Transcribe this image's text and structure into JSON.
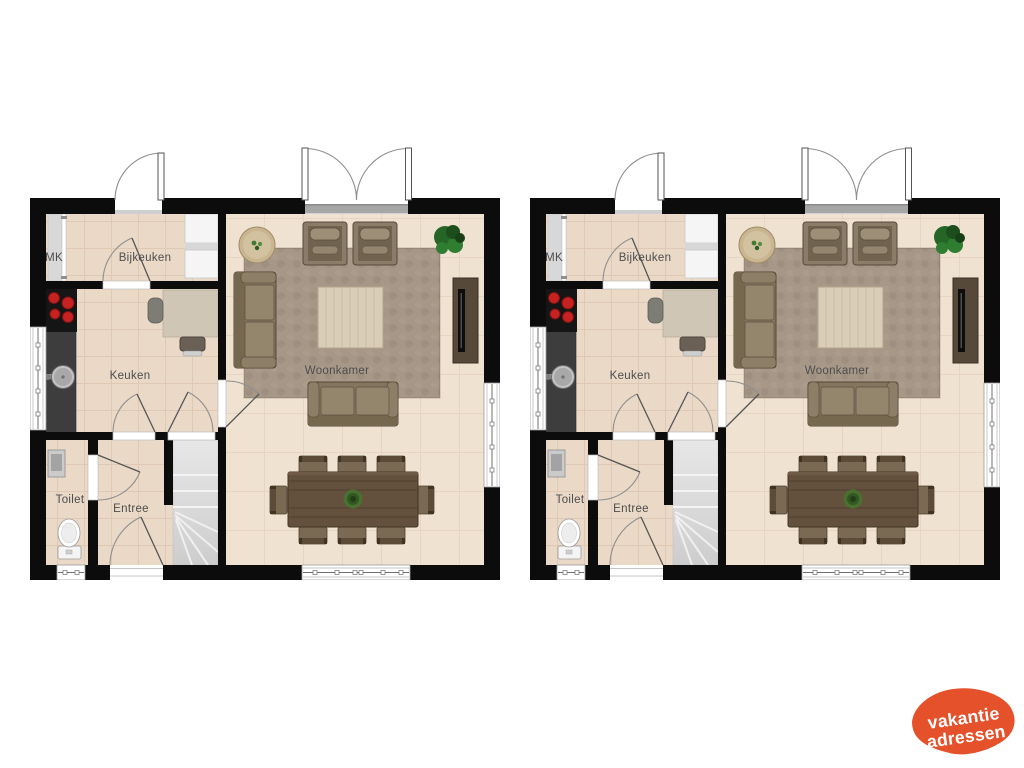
{
  "image_type": "real-estate floor plan, two identical plans side by side",
  "colors": {
    "wall": "#0c0c0c",
    "floor_small": "#ead9c7",
    "floor_large": "#efe2d1",
    "rug": "#a69787",
    "upholstery": "#84755f",
    "cushion": "#94856d",
    "wood_dark": "#63503d",
    "counter": "#3d3d3d",
    "burner": "#c62222",
    "stairs": "#d9d9d9",
    "plant_green": "#2f7d31",
    "label": "#4d4d4d",
    "logo_orange": "#e5512b",
    "logo_text": "#ffffff"
  },
  "rooms": {
    "bijkeuken": "Bijkeuken",
    "mk": "MK",
    "keuken": "Keuken",
    "woonkamer": "Woonkamer",
    "toilet": "Toilet",
    "entree": "Entree"
  },
  "logo": {
    "line1": "vakantie",
    "line2": "adressen"
  }
}
